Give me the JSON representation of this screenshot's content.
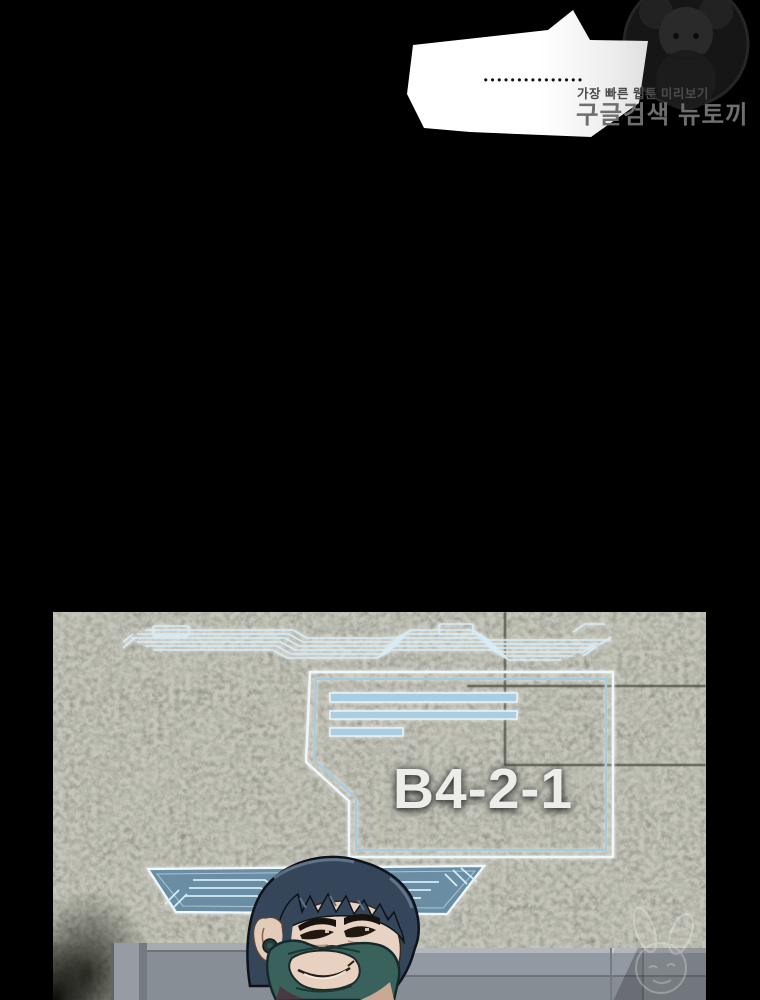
{
  "speech_bubble": {
    "dots": "●●●●●●●●●●●●●●●"
  },
  "site_watermark": {
    "tagline": "가장 빠른 웹툰 미리보기",
    "brand": "구글검색 뉴토끼",
    "emblem_icon": "rabbit-girl-emblem-icon"
  },
  "panel": {
    "sign_label": "B4-2-1",
    "sign_bars_count": 3,
    "icons": {
      "top_trace": "circuit-trace-icon",
      "banner": "hologram-banner-icon",
      "corner_watermark": "rabbit-watermark-icon"
    },
    "colors": {
      "wall": "#75766b",
      "hologram_line": "#d6ecf8",
      "hologram_fill": "#a9cde2",
      "banner_fill": "#55829c",
      "sign_text": "#ecede9",
      "mask": "#3a625d",
      "hair": "#36465a"
    }
  }
}
